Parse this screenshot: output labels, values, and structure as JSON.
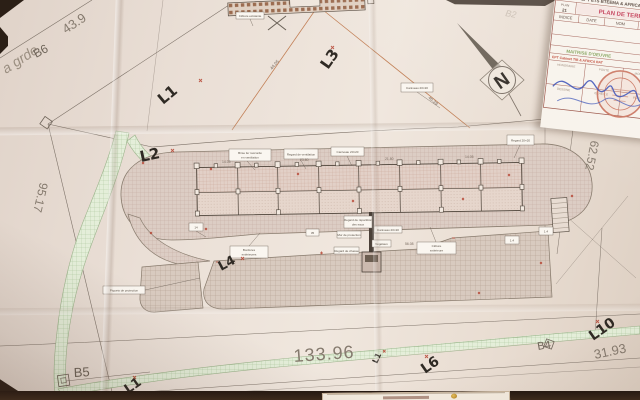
{
  "title_block": {
    "company": "EPT ETS BTEEMA & AFRICA COM'S",
    "doc_label": "PLAN",
    "doc_number": "21",
    "title": "PLAN DE TERRASSEMENT",
    "col_indice": "INDICE",
    "col_date": "DATE",
    "col_nom": "NOM",
    "col_modification": "MODIFICATION",
    "section_owner": "MAITRISE D'OEUVRE",
    "owner_line": "EPT Cabinet TIB & AFRICA BAT",
    "grid_cells": [
      "HONORAIRE",
      "PORTE",
      "MOBILIER",
      "SIGNE",
      "DESSINE",
      "ECHELLE",
      "INDIQUE",
      "FEUILLE"
    ]
  },
  "compass": {
    "letter": "N"
  },
  "hand_labels": {
    "l1_top": "L1",
    "l2": "L2",
    "l3": "L3",
    "l4": "L4",
    "l1_small": "L1",
    "l1_bottom": "L1",
    "l6": "L6",
    "l10": "L10"
  },
  "pencil_notes": {
    "a_grade": "a grde",
    "b2": "B2"
  },
  "survey_points": {
    "b4": "B4",
    "b5": "B5",
    "b6": "B6"
  },
  "dimensions": {
    "d43": "43.9",
    "d95": "95.17",
    "d133": "133.96",
    "d31": "31.93",
    "d62": "62.52",
    "d46": "46.39",
    "d44": "44.05"
  },
  "plan_numbers": {
    "pn1": "14.05",
    "pn2": "23.80",
    "pn3": "21.80",
    "pn4": "14.05",
    "pn5": "56.08"
  },
  "notes": {
    "n1": "Clôture existante",
    "n2": "Caniveau 20×20",
    "n3": "Regard 20×20",
    "n4a": "Brise fer raccordé",
    "n4b": "en ventilation",
    "n5": "Regard de ventilation",
    "n6": "Caniveau 20×20",
    "n7": "14",
    "n8a": "Bordures",
    "n8b": "extérieures",
    "n9": "35",
    "n10a": "Clôture",
    "n10b": "extérieure",
    "n11": "1.4",
    "n12": "1.4",
    "n13a": "Regard de répartition",
    "n13b": "des eaux",
    "n14": "Caniveau 20×20",
    "n15": "Mur de protection",
    "n16": "Végétaux",
    "n17": "Regard de chasse",
    "n18": "Piquets de protection"
  }
}
